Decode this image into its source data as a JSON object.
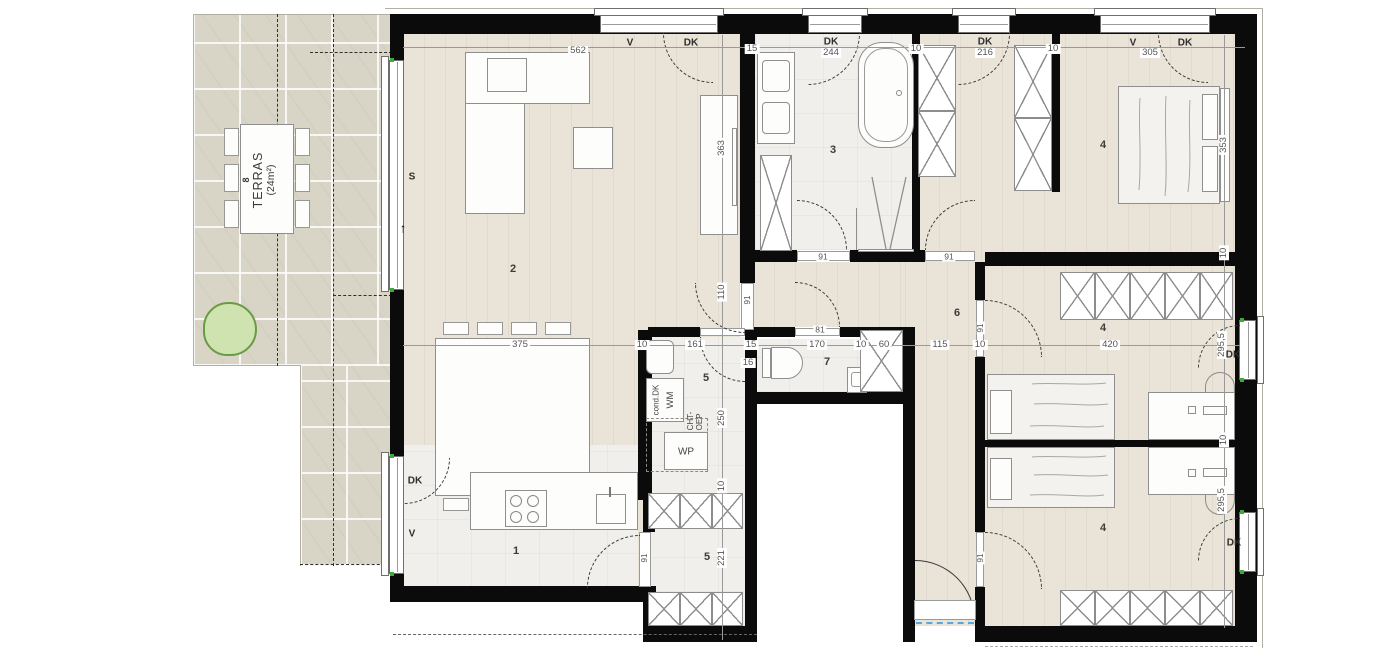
{
  "colors": {
    "wall": "#0b0b0b",
    "wood_floor": "#eae3d8",
    "tile_floor": "#f0efeb",
    "terrace_floor": "#d9d5c6",
    "accent_green": "#3faa35",
    "tree_fill": "#cfe3b0",
    "threshold_blue": "#58a8dd",
    "dim_text": "#555555"
  },
  "terrace": {
    "number": "8",
    "name": "TERRAS",
    "area": "(24m²)"
  },
  "rooms": {
    "kitchen": "1",
    "living": "2",
    "bath": "3",
    "bed_top": "4",
    "bed_mid": "4",
    "bed_bot": "4",
    "utility": "5",
    "storage": "5",
    "hall": "6",
    "wc": "7"
  },
  "dims": {
    "top": [
      "562",
      "15",
      "244",
      "10",
      "216",
      "10",
      "305"
    ],
    "mid": [
      "375",
      "10",
      "161",
      "15",
      "170",
      "10",
      "60",
      "115",
      "10",
      "420"
    ],
    "mid_extra": "16",
    "left_vertical": [
      "363",
      "110",
      "250",
      "10",
      "221"
    ],
    "right_vertical": [
      "353",
      "10",
      "295,5",
      "10",
      "295,5"
    ]
  },
  "windows": {
    "w1_v": "V",
    "w1_dk": "DK",
    "w2_dk": "DK",
    "w3_dk": "DK",
    "w4_v": "V",
    "w4_dk": "DK",
    "left_s": "S",
    "left_arrow": "↑",
    "leftb_dk": "DK",
    "leftb_v": "V",
    "right_mid_dk": "DK",
    "right_bot_dk": "DK"
  },
  "doors": {
    "living": "91",
    "bath": "91",
    "bed_top": "91",
    "wc": "81",
    "kitchen": "91",
    "bed_mid": "91",
    "bed_bot": "91"
  },
  "equipment": {
    "washer": "WM",
    "heat_pump": "WP",
    "cond": "cond.DK",
    "vent_1": "CHT-",
    "vent_2": "OEP"
  }
}
